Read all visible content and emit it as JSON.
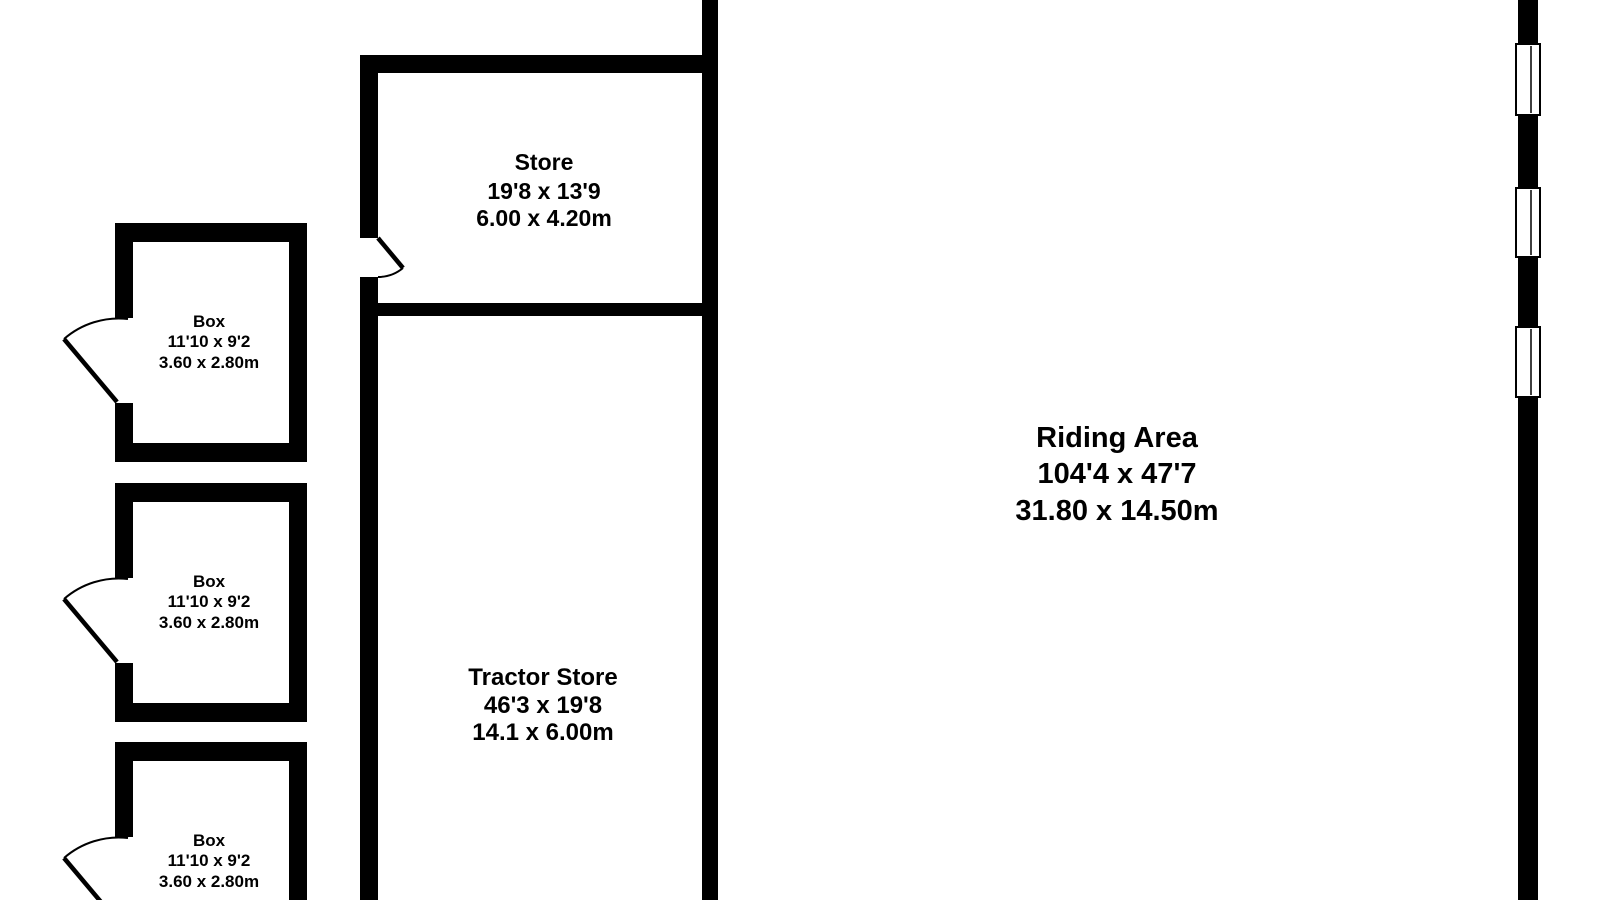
{
  "plan": {
    "background_color": "#ffffff",
    "wall_color": "#000000",
    "text_color": "#000000",
    "rooms": {
      "store": {
        "name": "Store",
        "imperial": "19'8 x 13'9",
        "metric": "6.00 x 4.20m"
      },
      "tractor_store": {
        "name": "Tractor Store",
        "imperial": "46'3 x 19'8",
        "metric": "14.1 x 6.00m"
      },
      "riding_area": {
        "name": "Riding Area",
        "imperial": "104'4 x 47'7",
        "metric": "31.80 x 14.50m"
      },
      "box_1": {
        "name": "Box",
        "imperial": "11'10 x 9'2",
        "metric": "3.60 x 2.80m"
      },
      "box_2": {
        "name": "Box",
        "imperial": "11'10 x 9'2",
        "metric": "3.60 x 2.80m"
      },
      "box_3": {
        "name": "Box",
        "imperial": "11'10 x 9'2",
        "metric": "3.60 x 2.80m"
      }
    }
  }
}
